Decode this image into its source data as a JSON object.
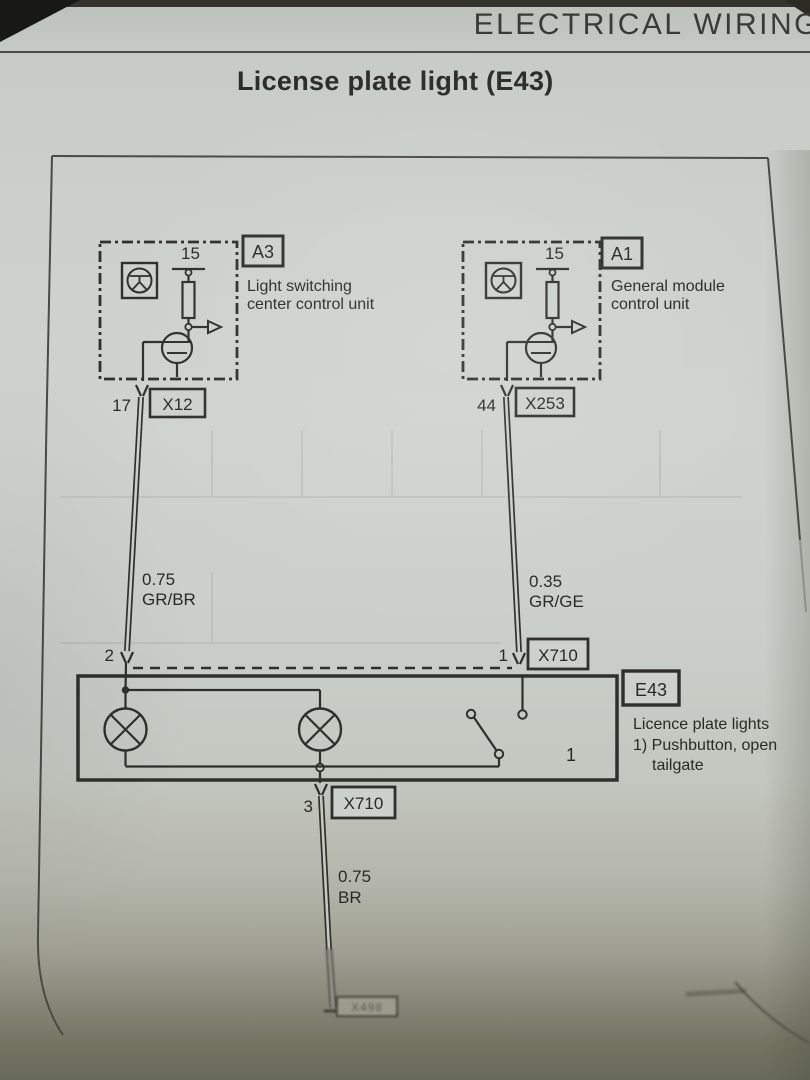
{
  "page": {
    "header": "ELECTRICAL WIRING",
    "title": "License plate light (E43)"
  },
  "modules": {
    "left": {
      "id": "A3",
      "terminal": "15",
      "name_line1": "Light switching",
      "name_line2": "center control unit",
      "pin": "17",
      "connector": "X12"
    },
    "right": {
      "id": "A1",
      "terminal": "15",
      "name_line1": "General module",
      "name_line2": "control unit",
      "pin": "44",
      "connector": "X253"
    }
  },
  "wires": {
    "left": {
      "pin": "2",
      "gauge": "0.75",
      "color_code": "GR/BR"
    },
    "right": {
      "pin": "1",
      "gauge": "0.35",
      "color_code": "GR/GE",
      "connector": "X710"
    },
    "ground": {
      "pin": "3",
      "gauge": "0.75",
      "color_code": "BR",
      "connector": "X710",
      "end_connector": "X498"
    }
  },
  "component": {
    "id": "E43",
    "name": "Licence plate lights",
    "footnote_line1": "1) Pushbutton, open",
    "footnote_line2": "tailgate",
    "switch_ref": "1"
  }
}
